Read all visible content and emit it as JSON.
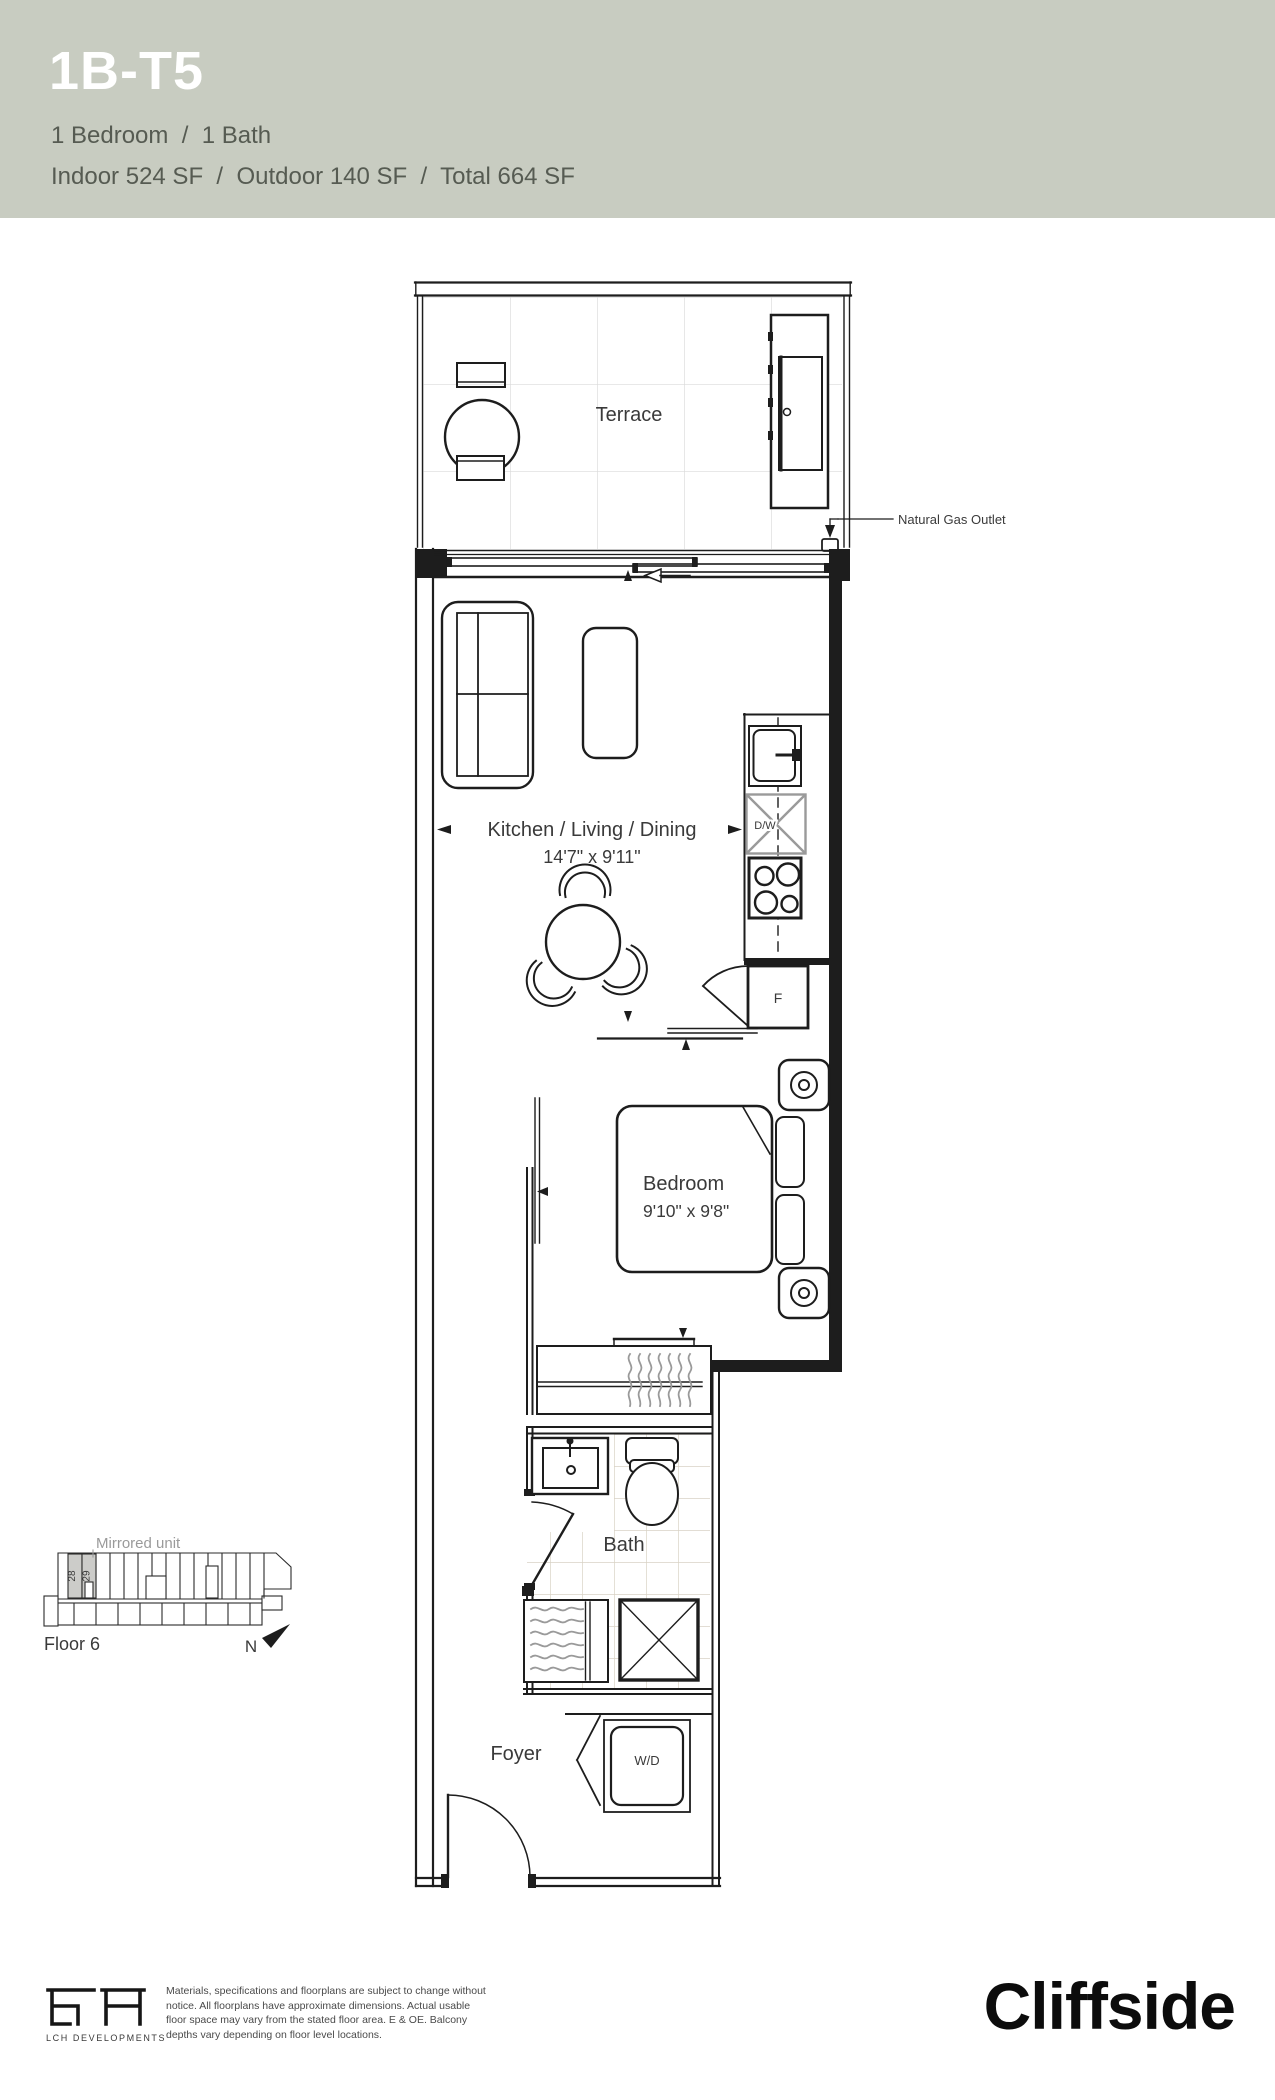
{
  "header": {
    "unit_code": "1B-T5",
    "configuration": "1 Bedroom  /  1 Bath",
    "areas": "Indoor 524 SF  /  Outdoor 140 SF  /  Total 664 SF"
  },
  "plan": {
    "labels": {
      "terrace": "Terrace",
      "natural_gas_outlet": "Natural Gas Outlet",
      "kitchen_living_dining": "Kitchen / Living / Dining",
      "kitchen_living_dining_dims": "14'7\" x 9'11\"",
      "dishwasher": "D/W",
      "fridge": "F",
      "bedroom": "Bedroom",
      "bedroom_dims": "9'10\" x 9'8\"",
      "bath": "Bath",
      "foyer": "Foyer",
      "washer_dryer": "W/D"
    }
  },
  "keyplan": {
    "mirrored_unit": "Mirrored unit",
    "unit_numbers": [
      "28",
      "29"
    ],
    "floor": "Floor 6",
    "north": "N"
  },
  "footer": {
    "logo_text": "LCH DEVELOPMENTS",
    "brand": "Cliffside",
    "disclaimer_lines": [
      "Materials, specifications and floorplans are subject to change without",
      "notice. All floorplans have approximate dimensions. Actual usable",
      "floor space may vary from the stated floor area. E & OE. Balcony",
      "depths vary depending on floor level locations."
    ]
  },
  "colors": {
    "header_bg": "#c8ccc1",
    "line": "#1d1d1d",
    "muted_gray": "#9a9a9a",
    "bath_tile": "#d8d2c5",
    "terrace_tile": "#dadada",
    "keyplan_highlight": "#ccccc9"
  }
}
